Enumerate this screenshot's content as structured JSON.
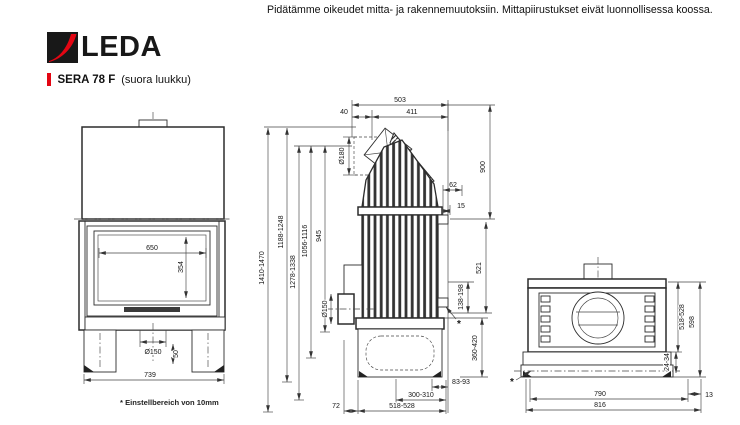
{
  "header": {
    "disclaimer": "Pidätämme oikeudet mitta- ja rakennemuutoksiin. Mittapiirustukset eivät luonnollisessa koossa.",
    "brand": "LEDA",
    "model": "SERA 78 F",
    "variant": "(suora luukku)"
  },
  "footnote": "* Einstellbereich von 10mm",
  "marks": {
    "asterisk": "*"
  },
  "colors": {
    "brand_red": "#e30613",
    "ink": "#2c2c2c"
  },
  "front": {
    "glass_w": "650",
    "glass_h": "354",
    "flue": "Ø150",
    "foot": "50",
    "width": "739"
  },
  "side": {
    "d503": "503",
    "d411": "411",
    "d40": "40",
    "flue_top": "Ø180",
    "h1": "1410-1470",
    "h2": "1188-1248",
    "h3": "1278-1338",
    "h4": "1056-1116",
    "h5": "945",
    "v900": "900",
    "d62": "62",
    "d15": "15",
    "v521": "521",
    "r138": "138-198",
    "flue_rear": "Ø150",
    "v360": "360-420",
    "d83": "83-93",
    "d300": "300-310",
    "d518": "518-528",
    "d72": "72"
  },
  "rear": {
    "v518": "518-528",
    "v598": "598",
    "v24": "24-34",
    "w790": "790",
    "w816": "816",
    "d13": "13"
  }
}
